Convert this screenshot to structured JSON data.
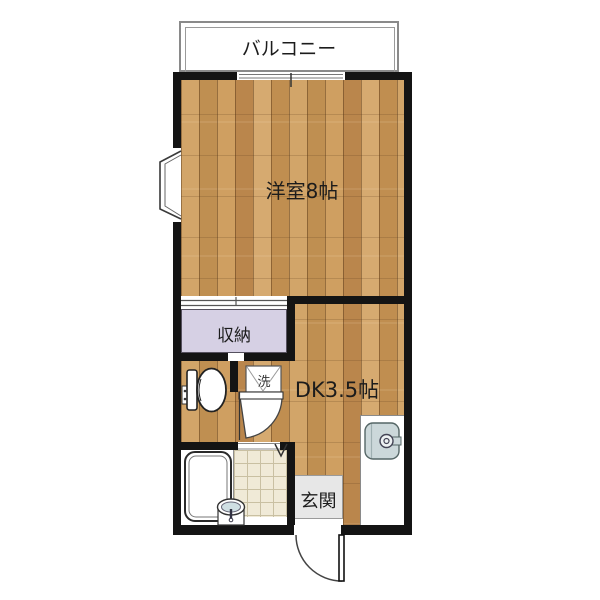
{
  "floorplan": {
    "rooms": {
      "balcony": {
        "label": "バルコニー"
      },
      "western_room": {
        "label": "洋室8帖"
      },
      "closet": {
        "label": "収納"
      },
      "dining_kitchen": {
        "label": "DK3.5帖"
      },
      "entrance": {
        "label": "玄関"
      },
      "laundry_pan": {
        "label": "洗"
      }
    },
    "colors": {
      "wall": "#141414",
      "wood_floor": "#c99a60",
      "closet_fill": "#d6d0e4",
      "tile_fill": "#f0ead7",
      "entrance_fill": "#e7e7e7",
      "kitchen_sink_fill": "#ccd8da",
      "washbasin_fill": "#cfdfe3"
    },
    "icons": {
      "toilet": "toilet-icon",
      "bathtub": "bathtub-icon",
      "washbasin": "washbasin-icon",
      "kitchen_sink": "kitchen-sink-icon",
      "washing_machine_pan": "washing-machine-pan-icon",
      "entry_door": "door-swing-icon",
      "toilet_door": "door-swing-icon",
      "folding_door": "folding-door-icon",
      "bay_window": "bay-window-icon",
      "sliding_window": "sliding-window-icon",
      "closet_sliding_door": "sliding-door-icon"
    }
  }
}
